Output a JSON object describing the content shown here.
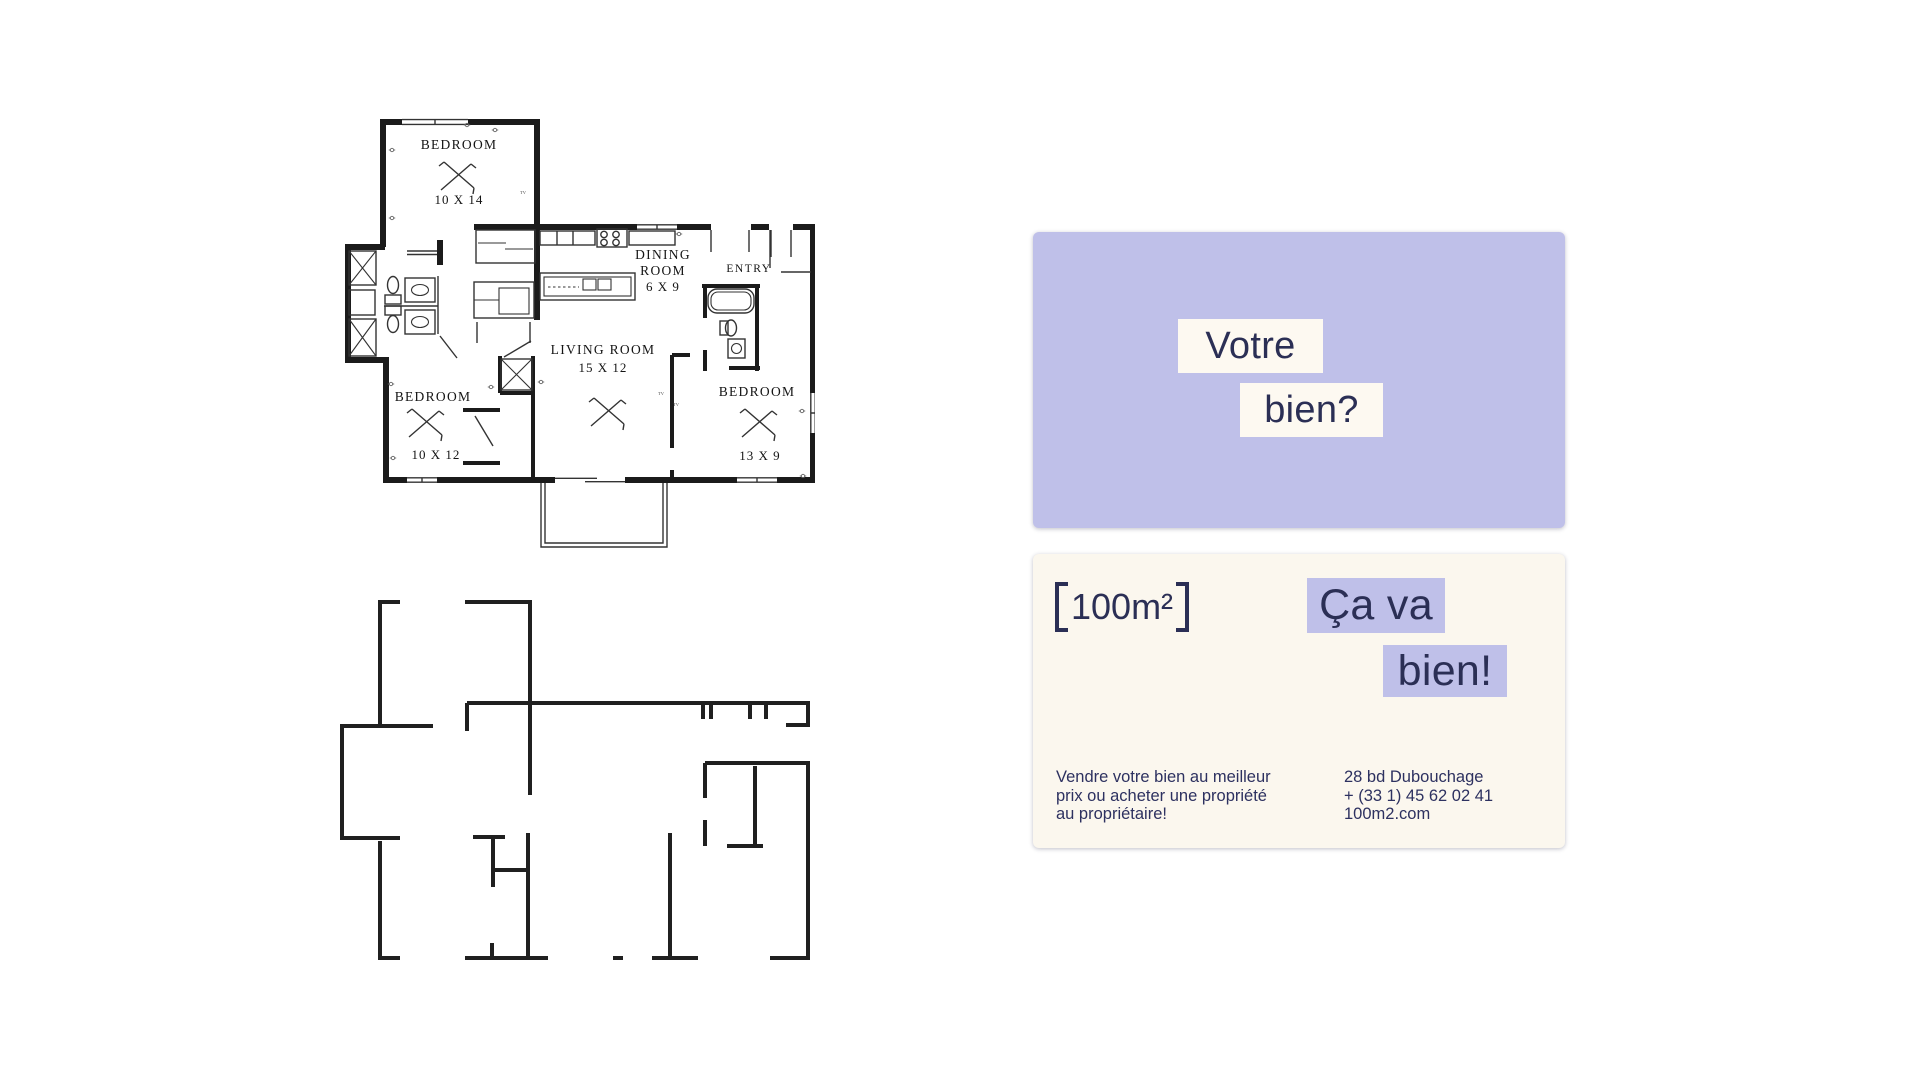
{
  "plan_labels": {
    "bedroom_top": "BEDROOM",
    "bedroom_top_dims": "10 X 14",
    "dining_line1": "DINING",
    "dining_line2": "ROOM",
    "dining_dims": "6 X 9",
    "entry": "ENTRY",
    "living": "LIVING ROOM",
    "living_dims": "15 X 12",
    "bedroom_left": "BEDROOM",
    "bedroom_left_dims": "10 X 12",
    "bedroom_right": "BEDROOM",
    "bedroom_right_dims": "13 X 9",
    "tv_marker": "TV"
  },
  "question_card": {
    "word1": "Votre",
    "word2": "bien?"
  },
  "answer_card": {
    "logo_text": "100m²",
    "word1": "Ça va",
    "word2": "bien!",
    "pitch_line1": "Vendre votre bien au meilleur",
    "pitch_line2": "prix ou acheter une propriété",
    "pitch_line3": "au propriétaire!",
    "address": "28 bd Dubouchage",
    "phone": "+ (33 1) 45 62 02 41",
    "website": "100m2.com"
  },
  "colors": {
    "lavender": "#bfc0e9",
    "cream": "#fbf7ee",
    "cream_box": "#fdf9f1",
    "navy": "#2b2f55",
    "plan_ink": "#1b1b1b"
  }
}
